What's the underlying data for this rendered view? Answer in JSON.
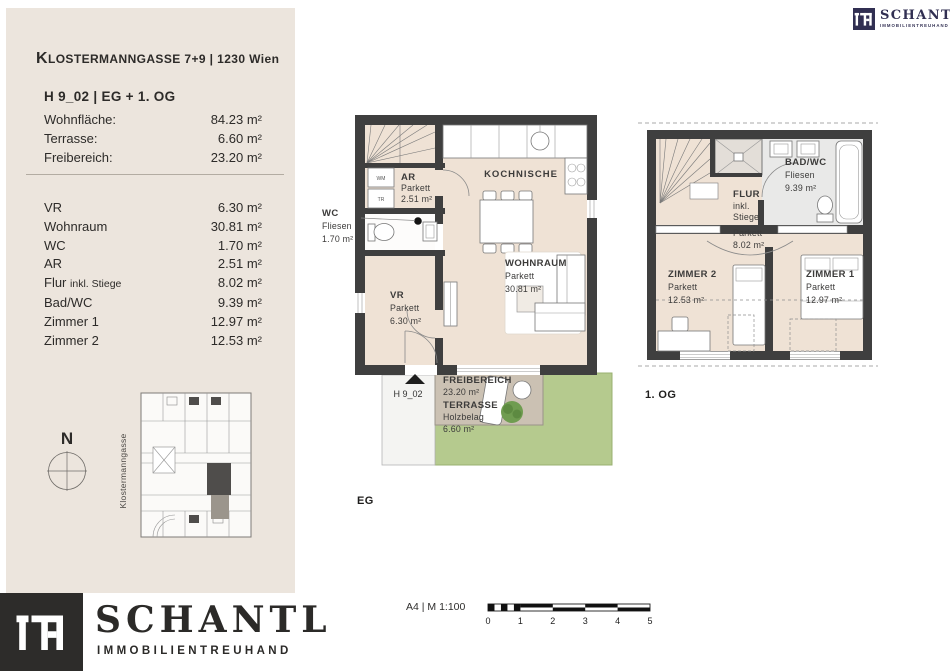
{
  "colors": {
    "sidebar_bg": "#ece5dd",
    "wall": "#3f3f3f",
    "floor": "#efe2d5",
    "bath": "#e9e9e8",
    "green": "#b5ca8e",
    "terrace": "#cbc1b3",
    "brand_navy": "#312f52",
    "brand_dark": "#2d2c2a"
  },
  "sidebar": {
    "title_first": "K",
    "title_rest": "LOSTERMANNGASSE 7+9 | 1230 Wien",
    "unit_title": "H 9_02 | EG + 1. OG",
    "summary": [
      {
        "label": "Wohnfläche:",
        "value": "84.23 m²"
      },
      {
        "label": "Terrasse:",
        "value": "6.60 m²"
      },
      {
        "label": "Freibereich:",
        "value": "23.20 m²"
      }
    ],
    "rooms": [
      {
        "label": "VR",
        "sub": "",
        "value": "6.30 m²"
      },
      {
        "label": "Wohnraum",
        "sub": "",
        "value": "30.81 m²"
      },
      {
        "label": "WC",
        "sub": "",
        "value": "1.70 m²"
      },
      {
        "label": "AR",
        "sub": "",
        "value": "2.51 m²"
      },
      {
        "label": "Flur",
        "sub": "inkl. Stiege",
        "value": "8.02 m²"
      },
      {
        "label": "Bad/WC",
        "sub": "",
        "value": "9.39 m²"
      },
      {
        "label": "Zimmer 1",
        "sub": "",
        "value": "12.97 m²"
      },
      {
        "label": "Zimmer 2",
        "sub": "",
        "value": "12.53 m²"
      }
    ],
    "compass_n": "N",
    "street": "Klostermanngasse"
  },
  "brand": {
    "name": "SCHANTL",
    "sub": "IMMOBILIENTREUHAND"
  },
  "plans": {
    "eg": {
      "floor_label": "EG",
      "unit_label": "H 9_02",
      "wm": "WM",
      "tr": "TR",
      "ar": {
        "l1": "AR",
        "l2": "Parkett",
        "l3": "2.51 m²"
      },
      "wc": {
        "l1": "WC",
        "l2": "Fliesen",
        "l3": "1.70 m²"
      },
      "kochnische": "KOCHNISCHE",
      "wohnraum": {
        "l1": "WOHNRAUM",
        "l2": "Parkett",
        "l3": "30.81 m²"
      },
      "vr": {
        "l1": "VR",
        "l2": "Parkett",
        "l3": "6.30 m²"
      },
      "outdoor": {
        "l1": "FREIBEREICH",
        "l2": "23.20 m²",
        "l3": "TERRASSE",
        "l4": "Holzbelag",
        "l5": "6.60 m²"
      }
    },
    "og": {
      "floor_label": "1. OG",
      "badwc": {
        "l1": "BAD/WC",
        "l2": "Fliesen",
        "l3": "9.39 m²"
      },
      "flur": {
        "l1": "FLUR",
        "l2": "inkl.",
        "l3": "Stiege",
        "l4": "Parkett",
        "l5": "8.02 m²"
      },
      "zimmer2": {
        "l1": "ZIMMER 2",
        "l2": "Parkett",
        "l3": "12.53 m²"
      },
      "zimmer1": {
        "l1": "ZIMMER 1",
        "l2": "Parkett",
        "l3": "12.97 m²"
      }
    }
  },
  "scalebar": {
    "label": "A4 | M 1:100",
    "ticks": [
      "0",
      "1",
      "2",
      "3",
      "4",
      "5"
    ]
  }
}
